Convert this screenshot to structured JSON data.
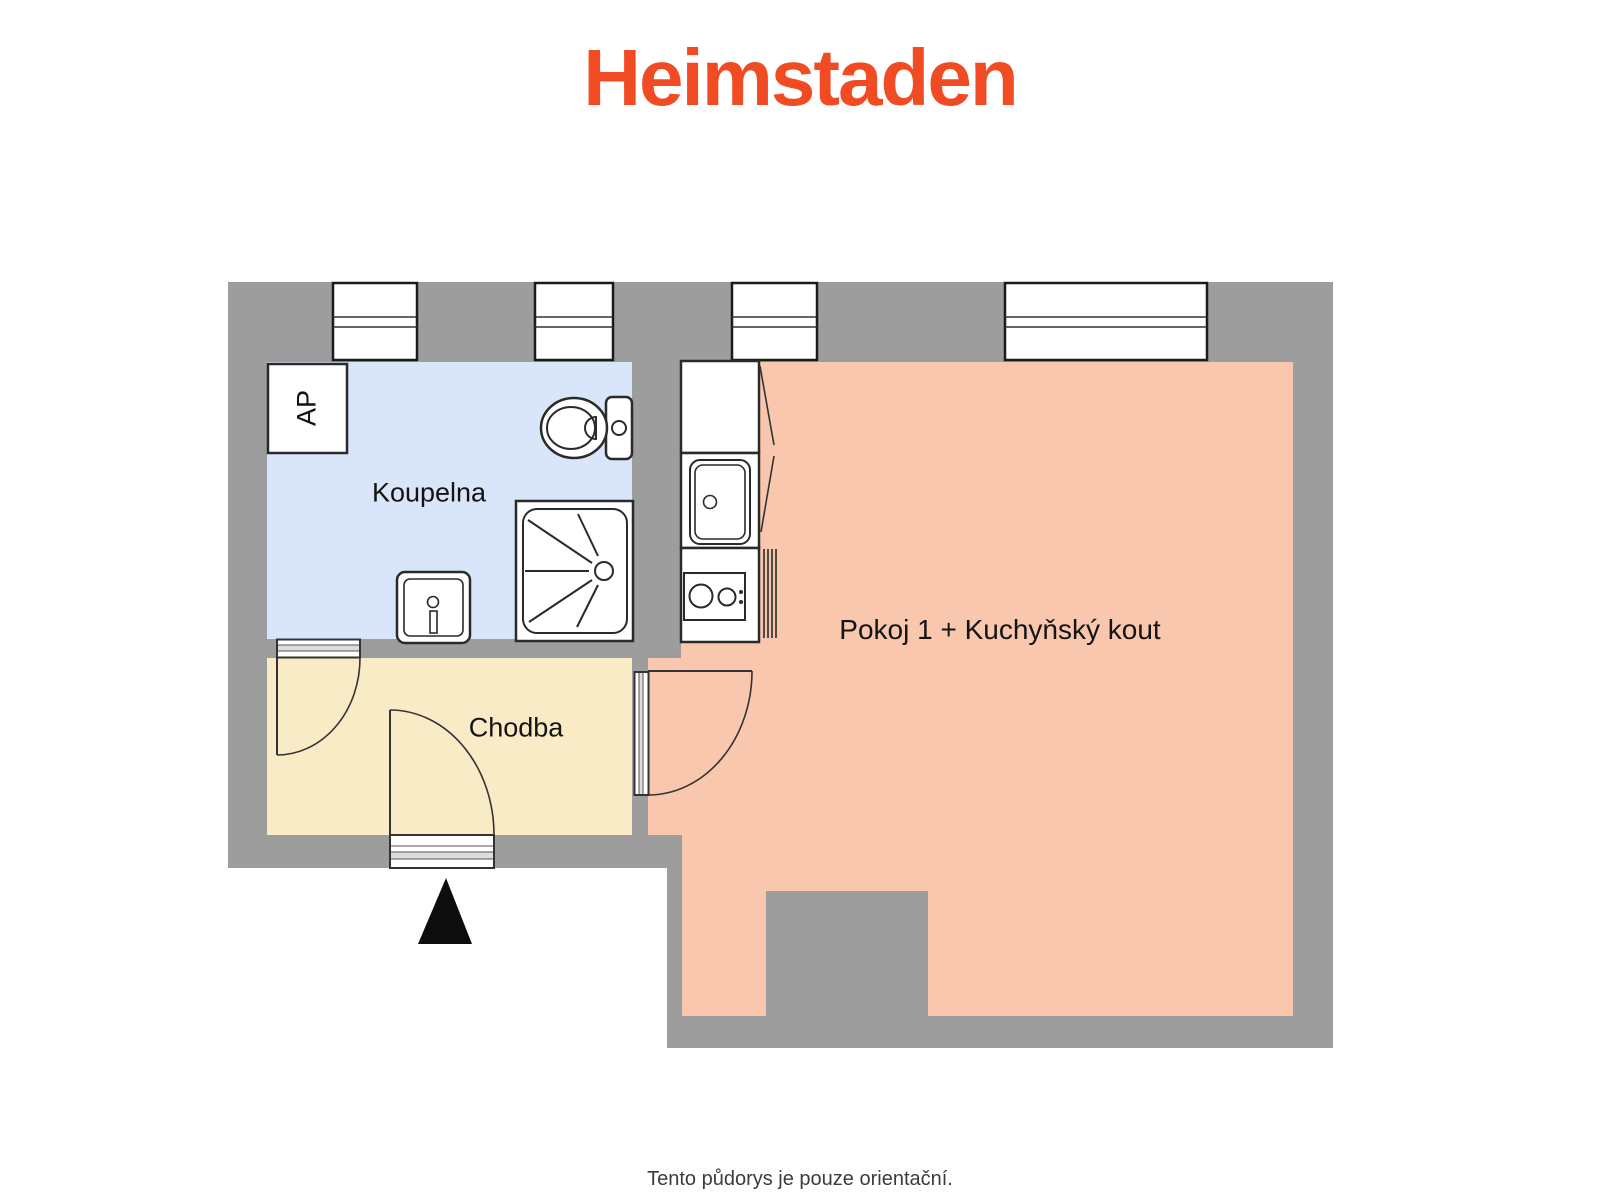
{
  "page": {
    "logo": "Heimstaden",
    "caption": "Tento půdorys je pouze orientační."
  },
  "colors": {
    "logo_orange": "#F04B23",
    "wall_gray": "#9D9D9D",
    "bathroom_blue": "#D9E5F8",
    "hallway_cream": "#FAEBC7",
    "room_salmon": "#F8C7AE",
    "caption_gray": "#3C3C3C",
    "threshold_gray": "#DCDCDC"
  },
  "floorplan": {
    "rooms": [
      {
        "id": "koupelna",
        "label": "Koupelna"
      },
      {
        "id": "chodba",
        "label": "Chodba"
      },
      {
        "id": "pokoj",
        "label": "Pokoj 1 + Kuchyňský kout"
      }
    ],
    "annotations": [
      {
        "id": "ap",
        "label": "AP"
      }
    ],
    "icons": [
      "toilet-icon",
      "shower-icon",
      "washbasin-icon",
      "kitchen-cabinet-icon",
      "kitchen-sink-icon",
      "stove-icon",
      "radiator-icon",
      "entrance-arrow-icon",
      "window-icon",
      "door-swing-icon"
    ]
  }
}
